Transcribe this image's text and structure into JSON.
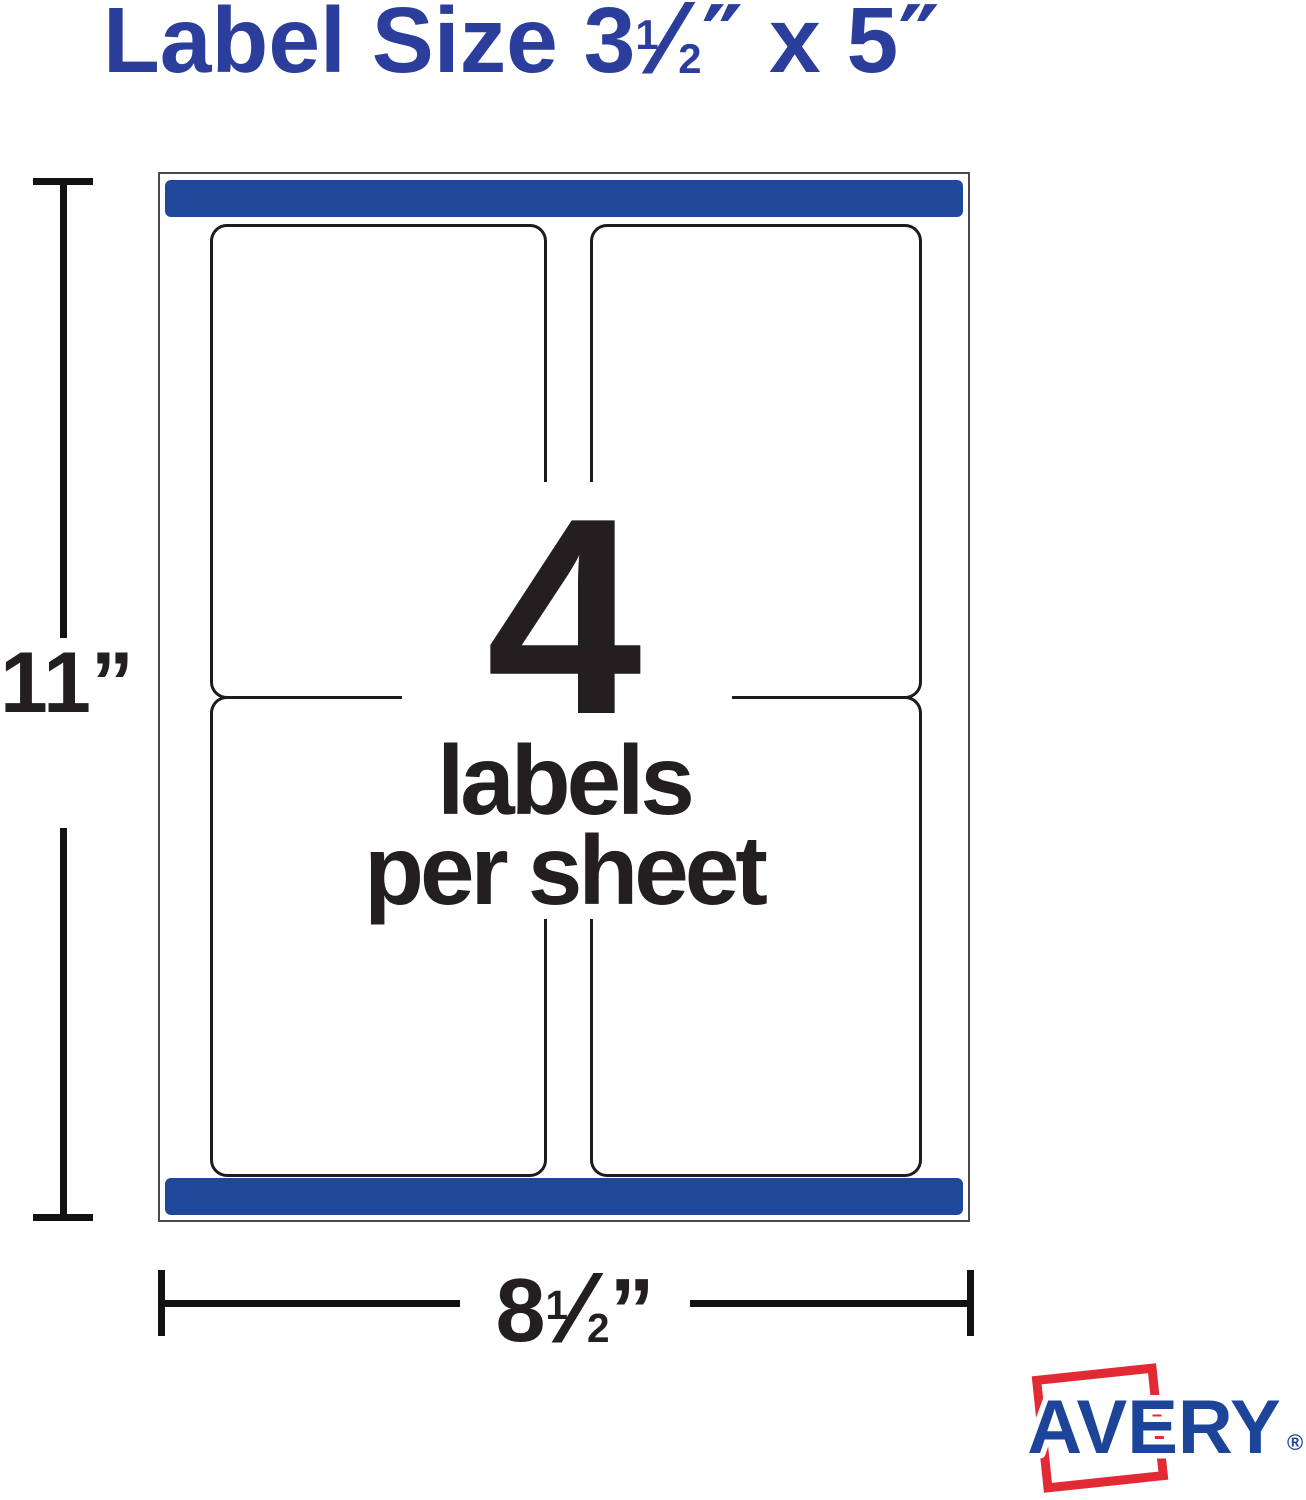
{
  "title": {
    "part1": "Label Size 3",
    "frac_num": "1",
    "frac_slash": "⁄",
    "frac_den": "2",
    "unit1": "″",
    "part2": " x 5",
    "unit2": "″"
  },
  "sheet_graphic": {
    "count": "4",
    "caption_line1": "labels",
    "caption_line2": "per sheet"
  },
  "dimensions": {
    "height_value": "11",
    "height_unit": "”",
    "width_whole": "8",
    "width_frac_num": "1",
    "width_frac_slash": "⁄",
    "width_frac_den": "2",
    "width_unit": "”"
  },
  "logo": {
    "brand": "AVERY",
    "registered": "®"
  },
  "colors": {
    "accent_blue": "#20489a",
    "title_blue": "#2b3e9c",
    "logo_blue": "#1c4599",
    "logo_red": "#e12a33",
    "ink": "#231f20",
    "sheet_border": "#4a4a4c",
    "label_border": "#1c1c1e",
    "dim_color": "#121212"
  }
}
